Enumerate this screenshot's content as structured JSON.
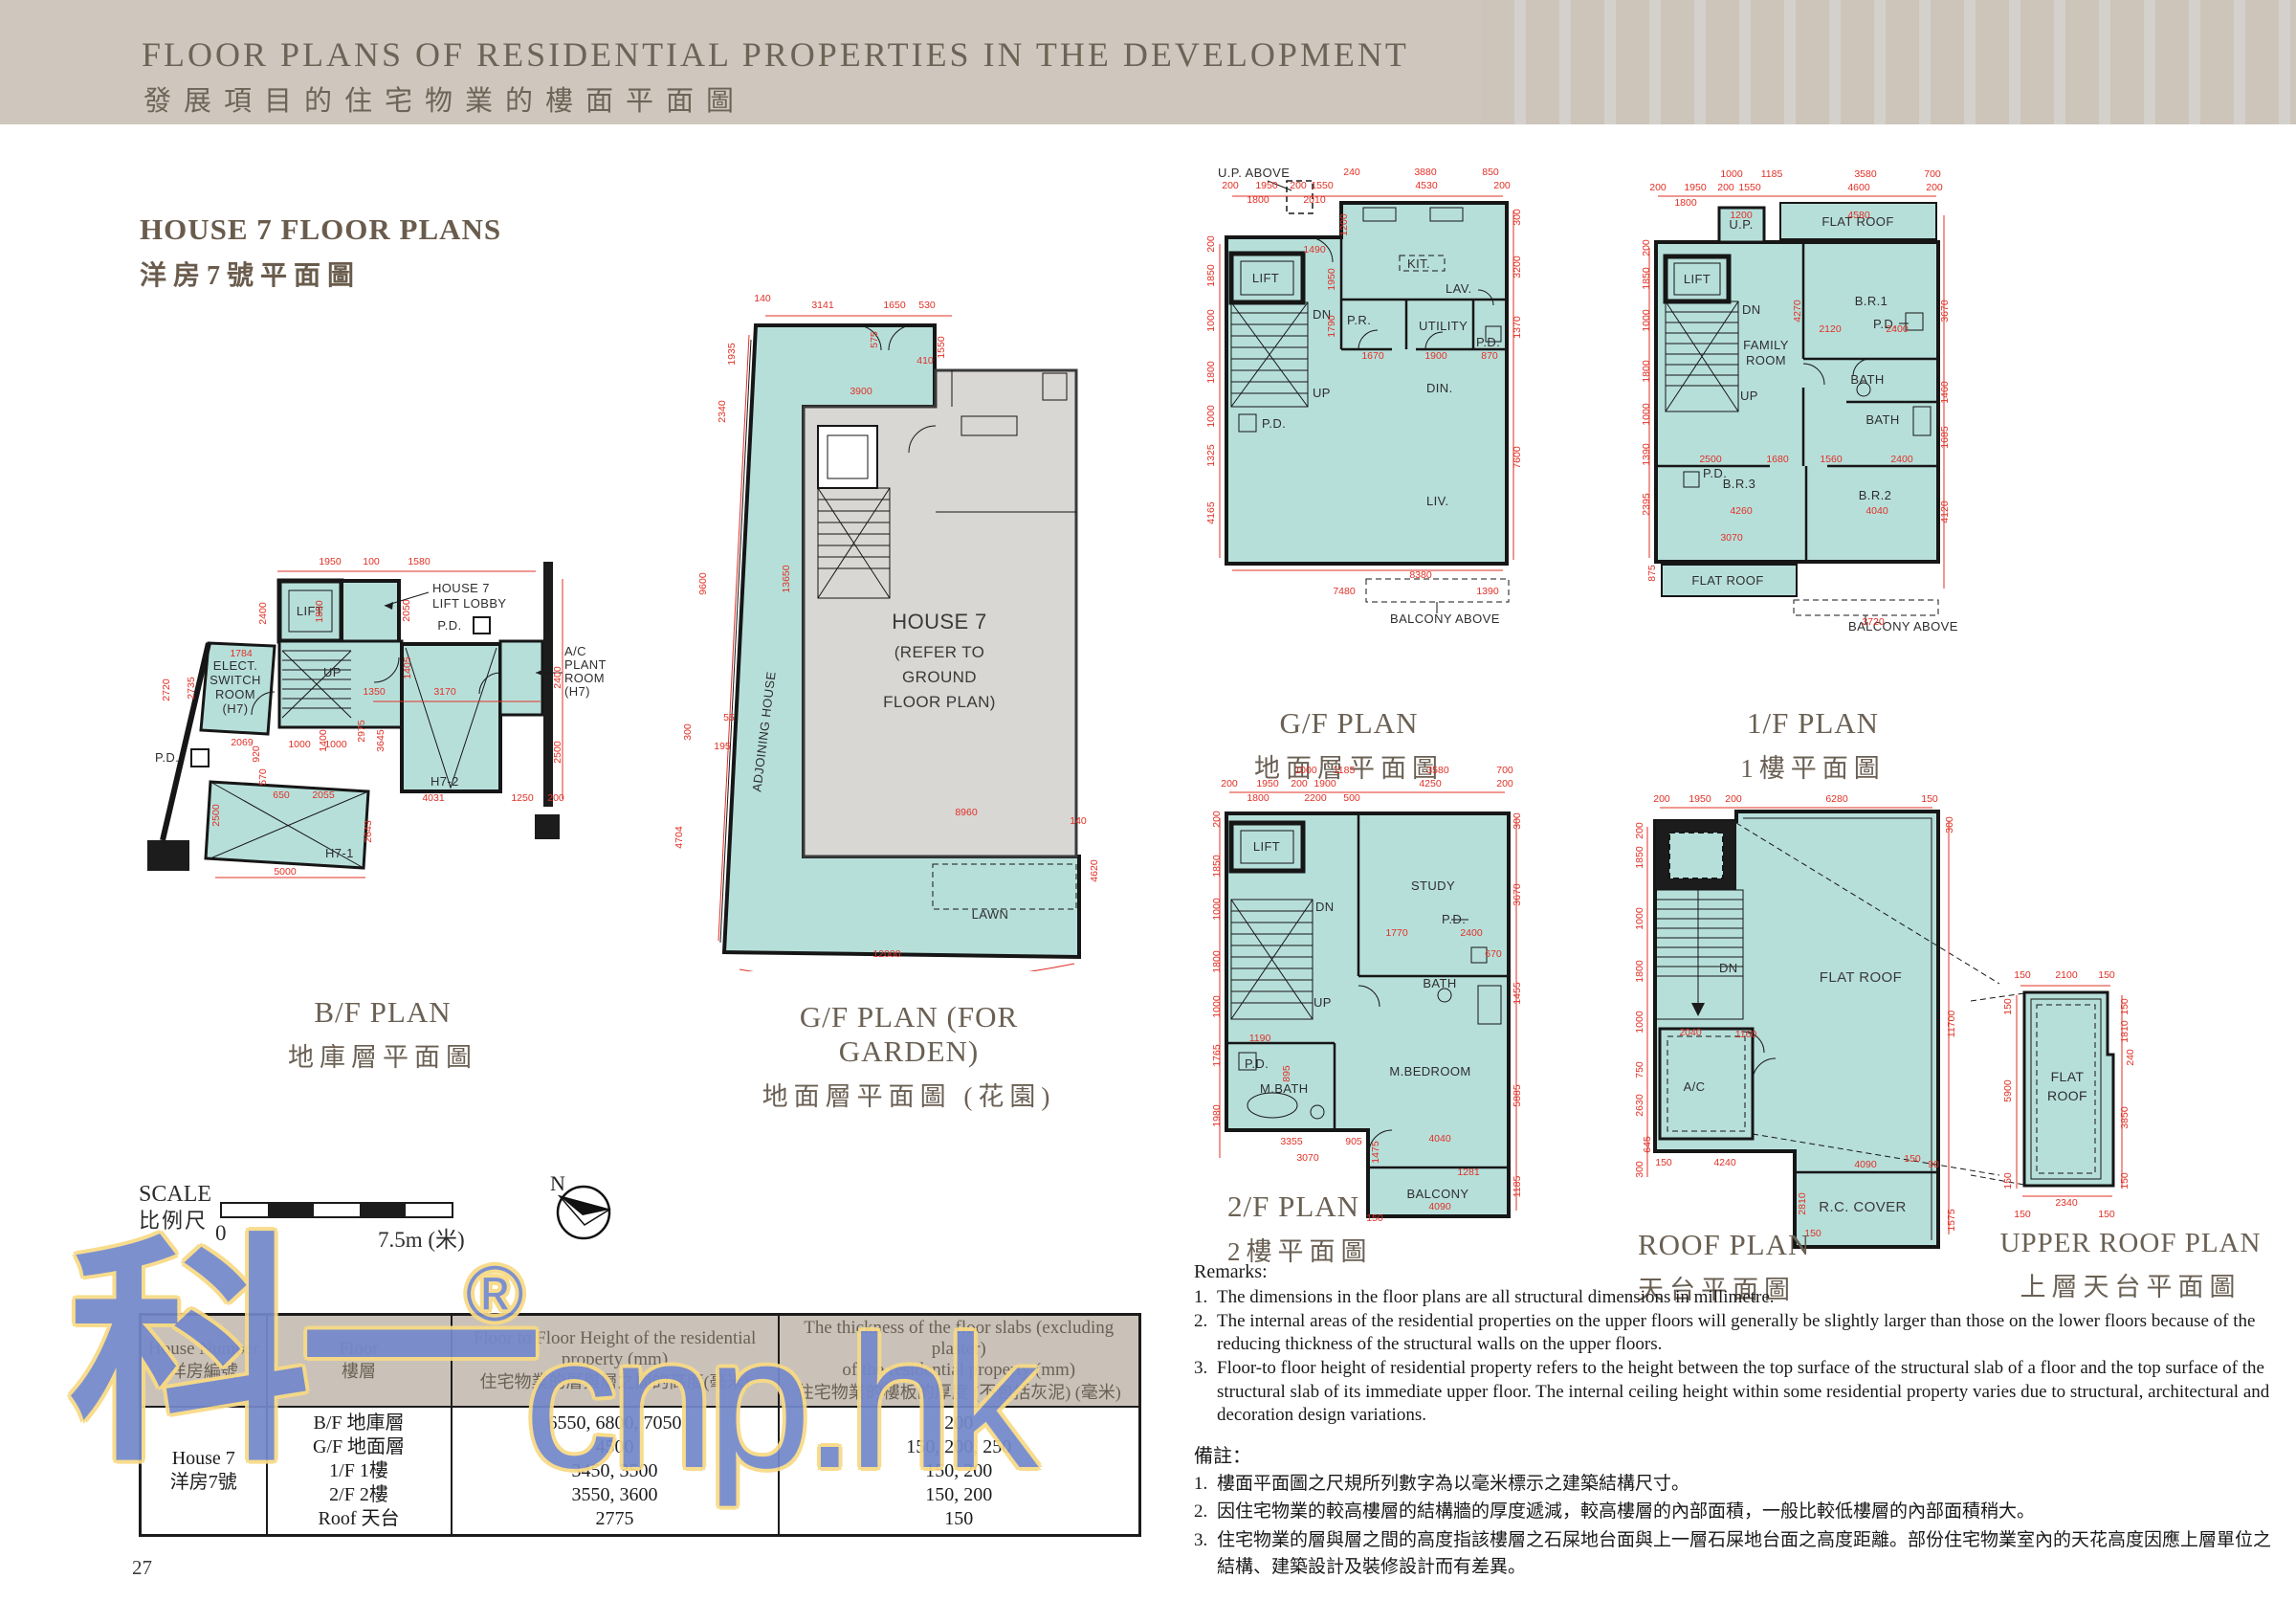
{
  "header": {
    "title_en": "FLOOR PLANS OF RESIDENTIAL PROPERTIES IN THE DEVELOPMENT",
    "title_zh": "發展項目的住宅物業的樓面平面圖"
  },
  "section": {
    "title_en": "HOUSE 7 FLOOR PLANS",
    "title_zh": "洋房7號平面圖"
  },
  "plans": {
    "bf": {
      "caption_en": "B/F PLAN",
      "caption_zh": "地庫層平面圖",
      "labels": {
        "lift": "LIFT",
        "lobby1": "HOUSE 7",
        "lobby2": "LIFT LOBBY",
        "elect1": "ELECT.",
        "elect2": "SWITCH",
        "elect3": "ROOM",
        "elect4": "(H7)",
        "ac1": "A/C",
        "ac2": "PLANT",
        "ac3": "ROOM",
        "ac4": "(H7)",
        "pd": "P.D.",
        "pd2": "P.D.",
        "up": "UP",
        "h71": "H7-1",
        "h72": "H7-2"
      },
      "dims": [
        "1950",
        "100",
        "1580",
        "2400",
        "1850",
        "2050",
        "1784",
        "2720",
        "2735",
        "1405",
        "1350",
        "3170",
        "2400",
        "2500",
        "2069",
        "920",
        "570",
        "1000",
        "1000",
        "1400",
        "2975",
        "3645",
        "650",
        "2055",
        "2500",
        "5000",
        "4031",
        "1250",
        "200",
        "2643"
      ]
    },
    "gfg": {
      "caption_en": "G/F PLAN (FOR GARDEN)",
      "caption_zh": "地面層平面圖 (花園)",
      "labels": {
        "house1": "HOUSE 7",
        "house2": "(REFER TO",
        "house3": "GROUND",
        "house4": "FLOOR PLAN)",
        "adjoining": "ADJOINING HOUSE",
        "lawn": "LAWN"
      },
      "dims": [
        "140",
        "3141",
        "1650",
        "530",
        "575",
        "1550",
        "410",
        "3900",
        "1935",
        "2340",
        "9600",
        "300",
        "13650",
        "55",
        "195",
        "4704",
        "4620",
        "8960",
        "140",
        "12000"
      ]
    },
    "gf": {
      "caption_en": "G/F PLAN",
      "caption_zh": "地面層平面圖",
      "labels": {
        "up_above": "U.P. ABOVE",
        "lift": "LIFT",
        "dn": "DN",
        "up": "UP",
        "kit": "KIT.",
        "lav": "LAV.",
        "pr": "P.R.",
        "utility": "UTILITY",
        "pd": "P.D.",
        "pd_left": "P.D.",
        "din": "DIN.",
        "liv": "LIV.",
        "balcony": "BALCONY ABOVE"
      },
      "dims": [
        "240",
        "3880",
        "850",
        "200",
        "1950",
        "200",
        "1550",
        "4530",
        "200",
        "1800",
        "2010",
        "1200",
        "1490",
        "1950",
        "1790",
        "1670",
        "1900",
        "870",
        "200",
        "1850",
        "1000",
        "1800",
        "1000",
        "1325",
        "4165",
        "300",
        "3200",
        "1370",
        "7600",
        "8380",
        "7480",
        "1390"
      ]
    },
    "ff": {
      "caption_en": "1/F PLAN",
      "caption_zh": "1樓平面圖",
      "labels": {
        "up_small": "U.P.",
        "flat_roof_top": "FLAT ROOF",
        "lift": "LIFT",
        "dn": "DN",
        "up": "UP",
        "family1": "FAMILY",
        "family2": "ROOM",
        "br1": "B.R.1",
        "pd": "P.D.",
        "bath1": "BATH",
        "bath2": "BATH",
        "br3": "B.R.3",
        "br2": "B.R.2",
        "pd2": "P.D.",
        "flat_roof_bottom": "FLAT ROOF",
        "balcony": "BALCONY ABOVE"
      },
      "dims": [
        "1000",
        "1185",
        "3580",
        "700",
        "200",
        "1950",
        "200",
        "1550",
        "4600",
        "200",
        "1800",
        "1200",
        "4580",
        "4270",
        "2120",
        "2400",
        "2500",
        "1680",
        "1560",
        "2400",
        "200",
        "1850",
        "1000",
        "1800",
        "1000",
        "1390",
        "2395",
        "875",
        "3670",
        "1460",
        "1685",
        "4120",
        "4260",
        "4040",
        "3070",
        "3720"
      ]
    },
    "sf": {
      "caption_en": "2/F PLAN",
      "caption_zh": "2樓平面圖",
      "labels": {
        "lift": "LIFT",
        "dn": "DN",
        "up": "UP",
        "study": "STUDY",
        "pd": "P.D.",
        "bath": "BATH",
        "mbath": "M.BATH",
        "pd2": "P.D.",
        "mbed": "M.BEDROOM",
        "balcony": "BALCONY"
      },
      "dims": [
        "1000",
        "1185",
        "3580",
        "700",
        "200",
        "1950",
        "200",
        "1900",
        "4250",
        "200",
        "1800",
        "2200",
        "500",
        "1770",
        "2400",
        "670",
        "1190",
        "895",
        "200",
        "1850",
        "1000",
        "1800",
        "1000",
        "1765",
        "1980",
        "300",
        "3670",
        "1455",
        "5885",
        "1185",
        "3355",
        "905",
        "1475",
        "4040",
        "3070",
        "1281",
        "4090",
        "150"
      ]
    },
    "roof": {
      "caption_en": "ROOF PLAN",
      "caption_zh": "天台平面圖",
      "labels": {
        "dn": "DN",
        "flat_roof": "FLAT ROOF",
        "ac": "A/C",
        "rc": "R.C. COVER"
      },
      "dims": [
        "200",
        "1950",
        "200",
        "6280",
        "150",
        "300",
        "11700",
        "1575",
        "200",
        "1850",
        "1000",
        "1800",
        "1000",
        "750",
        "2630",
        "645",
        "300",
        "2040",
        "1160",
        "150",
        "4240",
        "4090",
        "150",
        "2810",
        "150",
        "90"
      ]
    },
    "uroof": {
      "caption_en": "UPPER ROOF PLAN",
      "caption_zh": "上層天台平面圖",
      "labels": {
        "fr1": "FLAT",
        "fr2": "ROOF"
      },
      "dims": [
        "150",
        "2100",
        "150",
        "150",
        "1810",
        "240",
        "3850",
        "150",
        "150",
        "5900",
        "150",
        "2340",
        "150",
        "150"
      ]
    }
  },
  "scale": {
    "label_en": "SCALE",
    "label_zh": "比例尺",
    "zero": "0",
    "max": "7.5m (米)",
    "north": "N"
  },
  "table": {
    "col1_en": "House Number",
    "col1_zh": "洋房編號",
    "col2_en": "Floor",
    "col2_zh": "樓層",
    "col3_en1": "Floor to Floor Height of the residential",
    "col3_en2": "property (mm)",
    "col3_zh": "住宅物業的層與層之間的高度(毫米)",
    "col4_en1": "The thickness of the floor slabs (excluding plaster)",
    "col4_en2": "of the residential property (mm)",
    "col4_zh": "住宅物業的樓板的厚度 (不包括灰泥) (毫米)",
    "row": {
      "house_en": "House 7",
      "house_zh": "洋房7號",
      "floors": [
        "B/F 地庫層",
        "G/F 地面層",
        "1/F 1樓",
        "2/F 2樓",
        "Roof 天台"
      ],
      "heights": [
        "6550, 6800, 7050",
        "4500",
        "3450, 3500",
        "3550, 3600",
        "2775"
      ],
      "thickness": [
        "200",
        "150, 200, 250",
        "150, 200",
        "150, 200",
        "150"
      ]
    }
  },
  "remarks": {
    "title": "Remarks:",
    "nums": [
      "1.",
      "2.",
      "3."
    ],
    "items": [
      "The dimensions in the floor plans are all structural dimensions in millimetre.",
      "The internal areas of the residential properties on the upper floors will generally be slightly larger than those on the lower floors because of the reducing thickness of the structural walls on the upper floors.",
      "Floor-to floor height of residential property refers to the height between the top surface of the structural slab of a floor and the top surface of the structural slab of its immediate upper floor. The internal ceiling height within some residential property varies due to structural, architectural and decoration design variations."
    ],
    "title_zh": "備註：",
    "items_zh": [
      "樓面平面圖之尺規所列數字為以毫米標示之建築結構尺寸。",
      "因住宅物業的較高樓層的結構牆的厚度遞減，較高樓層的內部面積，一般比較低樓層的內部面積稍大。",
      "住宅物業的層與層之間的高度指該樓層之石屎地台面與上一層石屎地台面之高度距離。部份住宅物業室內的天花高度因應上層單位之結構、建築設計及裝修設計而有差異。"
    ]
  },
  "watermark": {
    "mark": "科一",
    "reg": "®",
    "domain": "cnp.hk"
  },
  "page_number": "27"
}
